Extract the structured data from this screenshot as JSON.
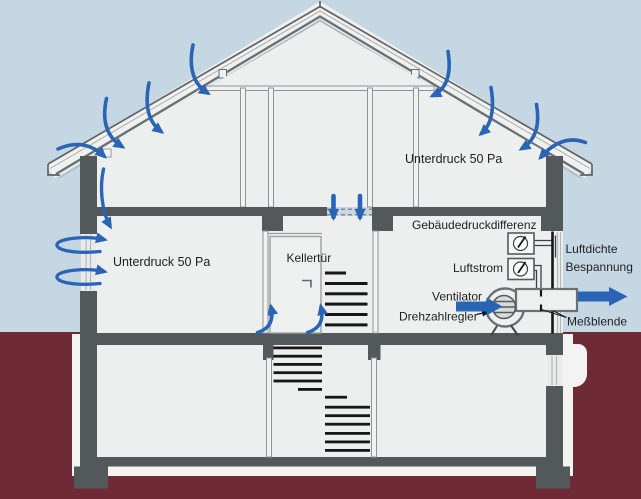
{
  "labels": {
    "attic_pressure": "Unterdruck 50 Pa",
    "ground_pressure": "Unterdruck 50 Pa",
    "basement_door": "Kellertür",
    "building_pressure_difference": "Gebäudedruckdifferenz",
    "airflow": "Luftstrom",
    "airtight_cover_line1": "Luftdichte",
    "airtight_cover_line2": "Bespannung",
    "fan": "Ventilator",
    "speed_controller": "Drehzahlregler",
    "measuring_orifice": "Meßblende"
  },
  "colors": {
    "c-sky": "#c6d7e4",
    "c-ground": "#6e2a35",
    "c-wall": "#53585a",
    "c-interior": "#edefee",
    "c-white": "#f3f3f1",
    "c-line": "#8e9396",
    "c-dark": "#161616",
    "c-blue": "#2a65b5",
    "c-text": "#1f1f1f"
  }
}
